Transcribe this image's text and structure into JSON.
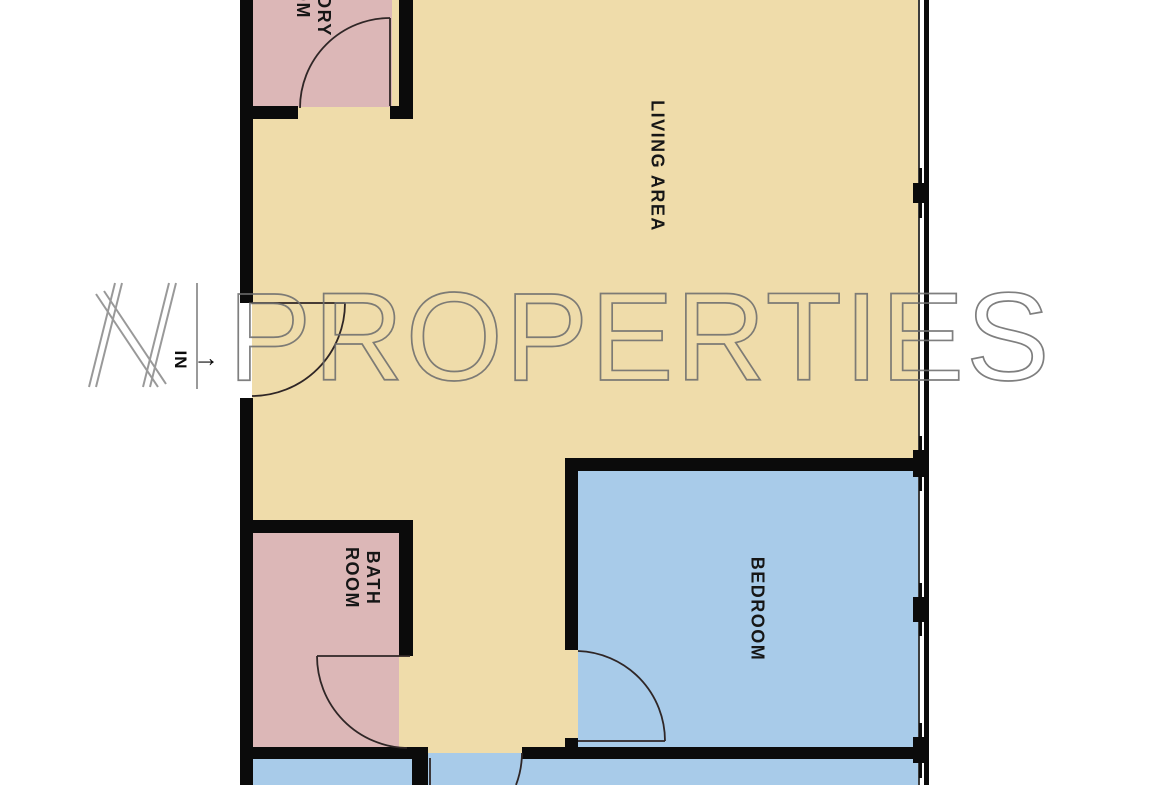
{
  "watermark": {
    "brand_letter": "N",
    "brand_name": "PROPERTIES",
    "color": "#6e6e6e"
  },
  "entry": {
    "label": "IN",
    "arrow": "→"
  },
  "rooms": {
    "living": {
      "label": "LIVING AREA",
      "color": "#efdcaa"
    },
    "laundry": {
      "label_line1": "LAUNDRY",
      "label_line2": "ROOM",
      "color": "#dcb7b7"
    },
    "bathroom": {
      "label_line1": "BATH",
      "label_line2": "ROOM",
      "color": "#dcb7b7"
    },
    "bedroom": {
      "label": "BEDROOM",
      "color": "#a8cbe9"
    },
    "bottom_rooms": {
      "color": "#a8cbe9"
    }
  },
  "structure": {
    "wall_color": "#0b0b0b",
    "door_arc_color": "#2f2626",
    "window_side": "right"
  }
}
